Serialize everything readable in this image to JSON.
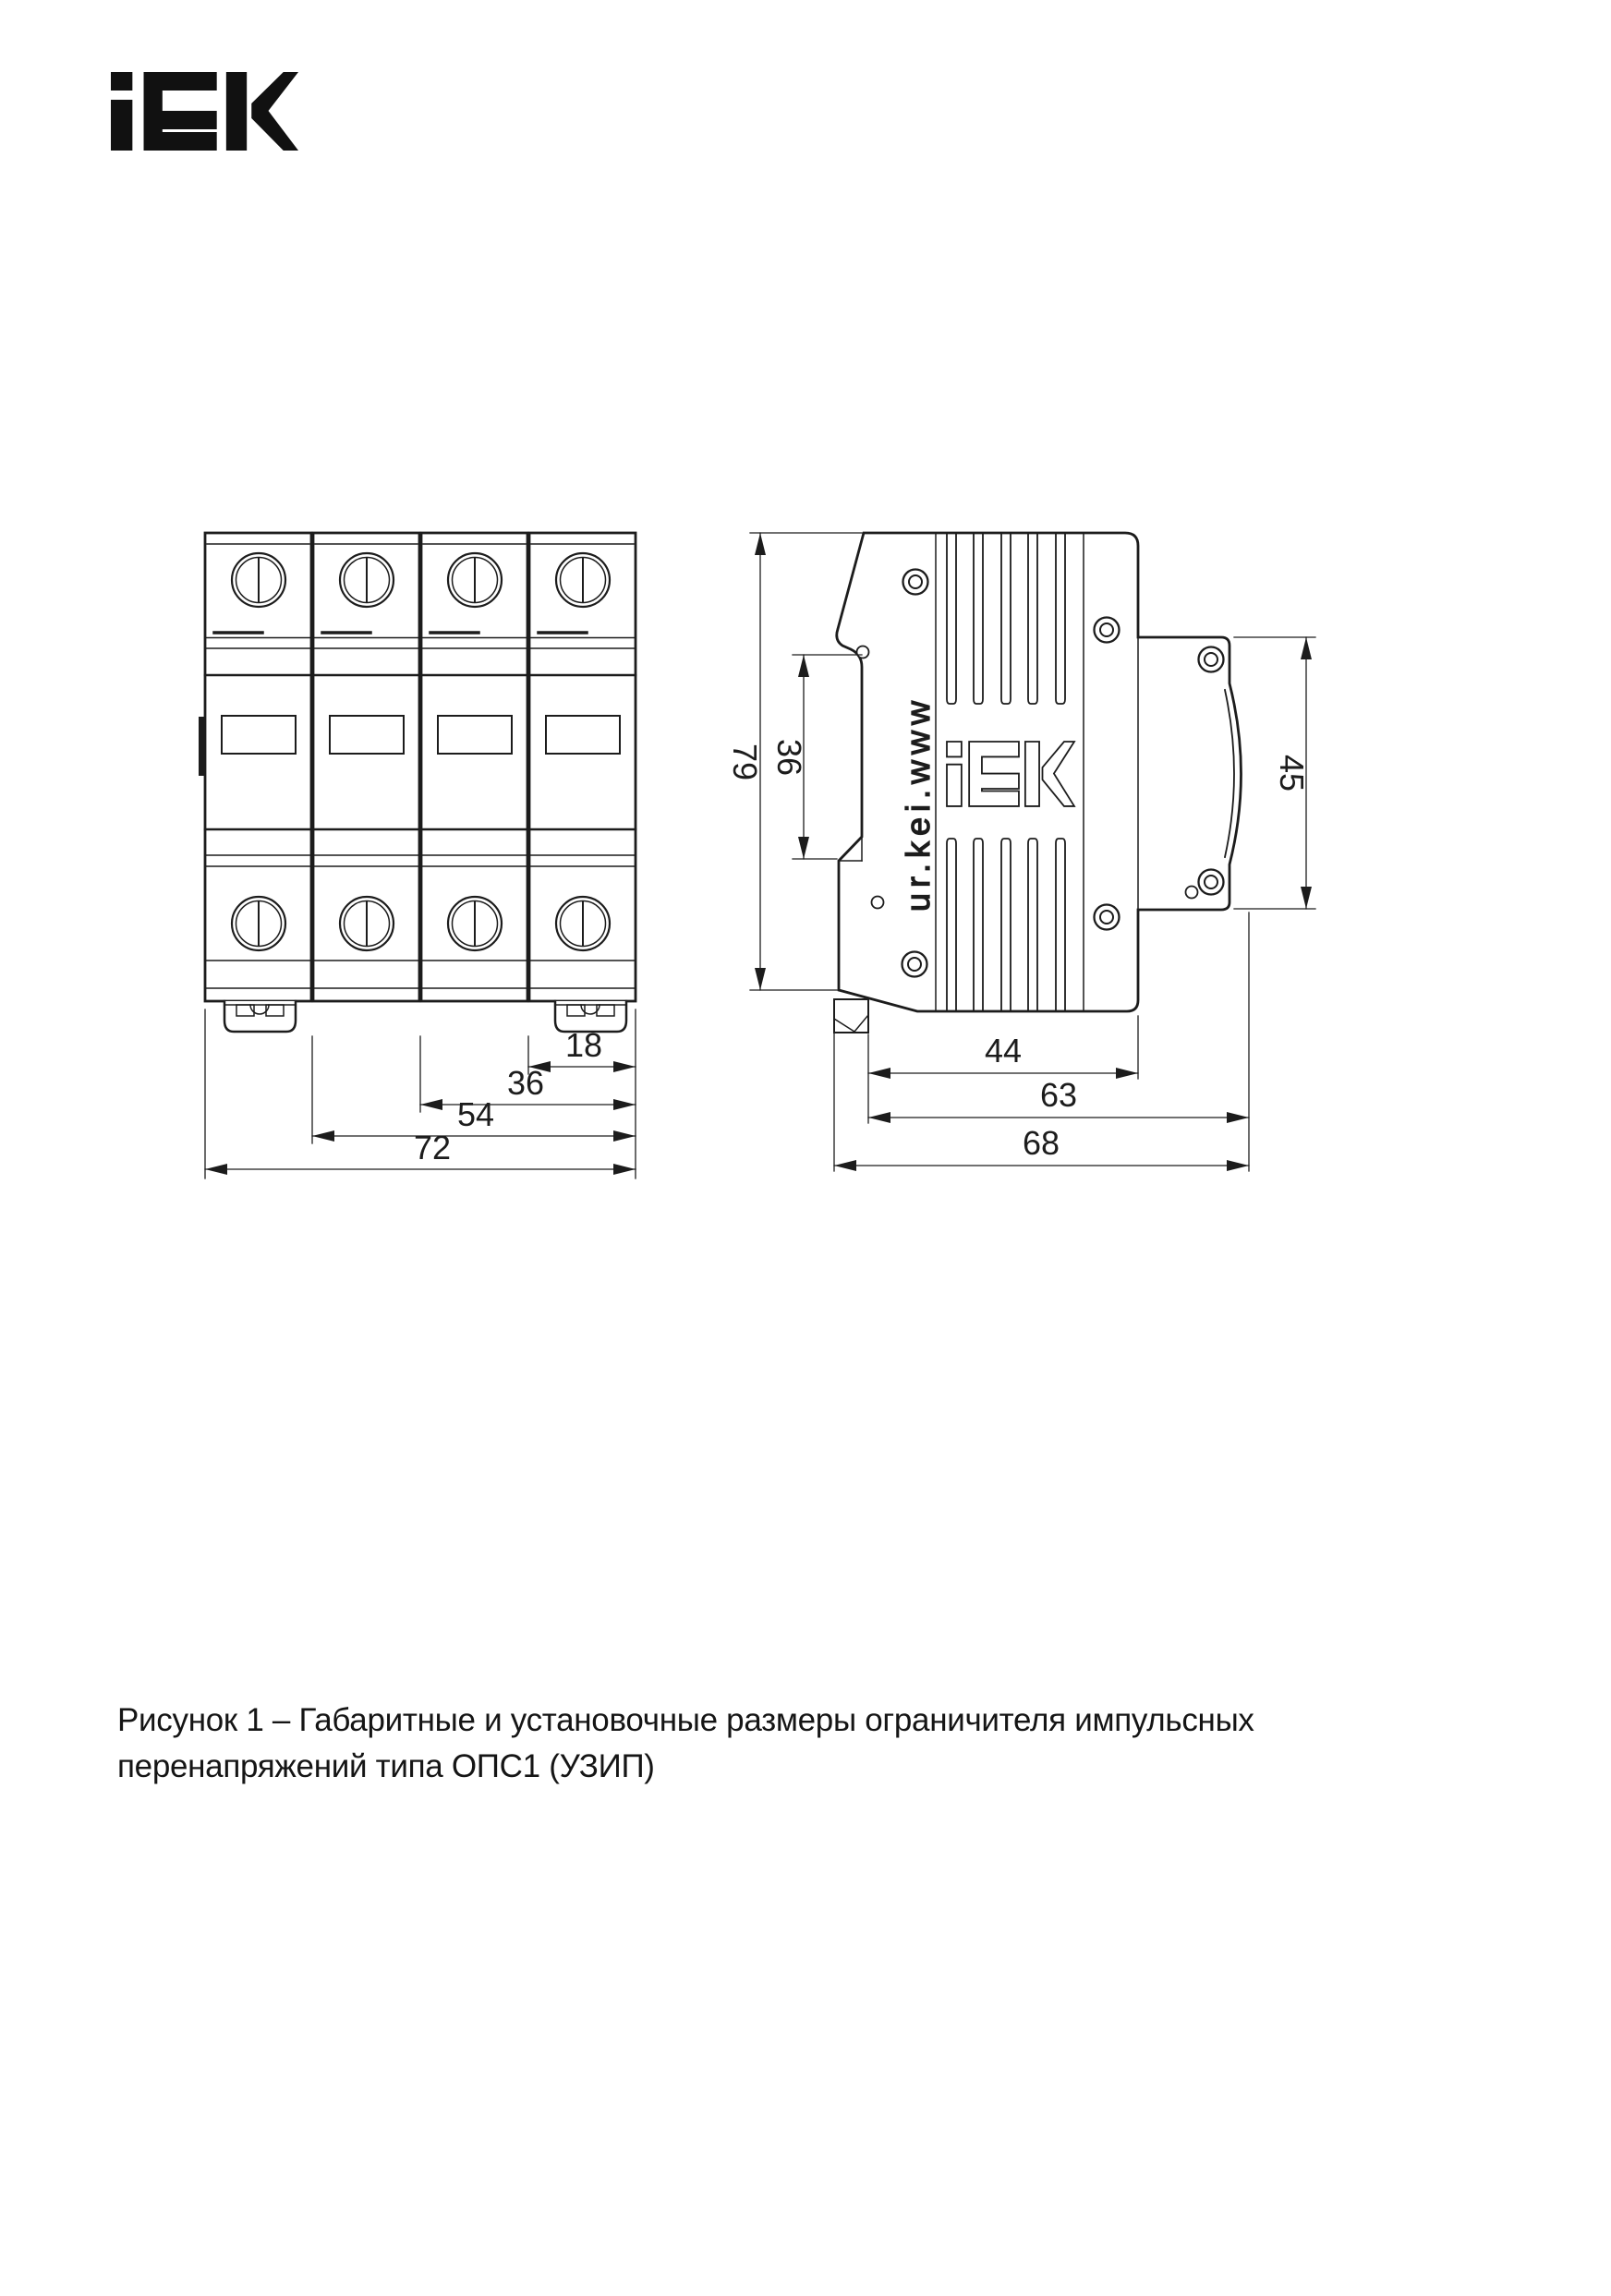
{
  "colors": {
    "ink": "#1c1c1c",
    "paper": "#ffffff"
  },
  "header": {
    "brand": "iEK"
  },
  "front_view": {
    "dims": {
      "w18": "18",
      "w36": "36",
      "w54": "54",
      "w72": "72"
    }
  },
  "side_view": {
    "dims": {
      "h79": "79",
      "h36": "36",
      "h45": "45",
      "d44": "44",
      "d63": "63",
      "d68": "68"
    },
    "engraving_url": "www.iek.ru"
  },
  "caption": {
    "line1": "Рисунок 1 – Габаритные и установочные размеры ограничителя импульсных",
    "line2": "перенапряжений типа ОПС1 (УЗИП)"
  }
}
